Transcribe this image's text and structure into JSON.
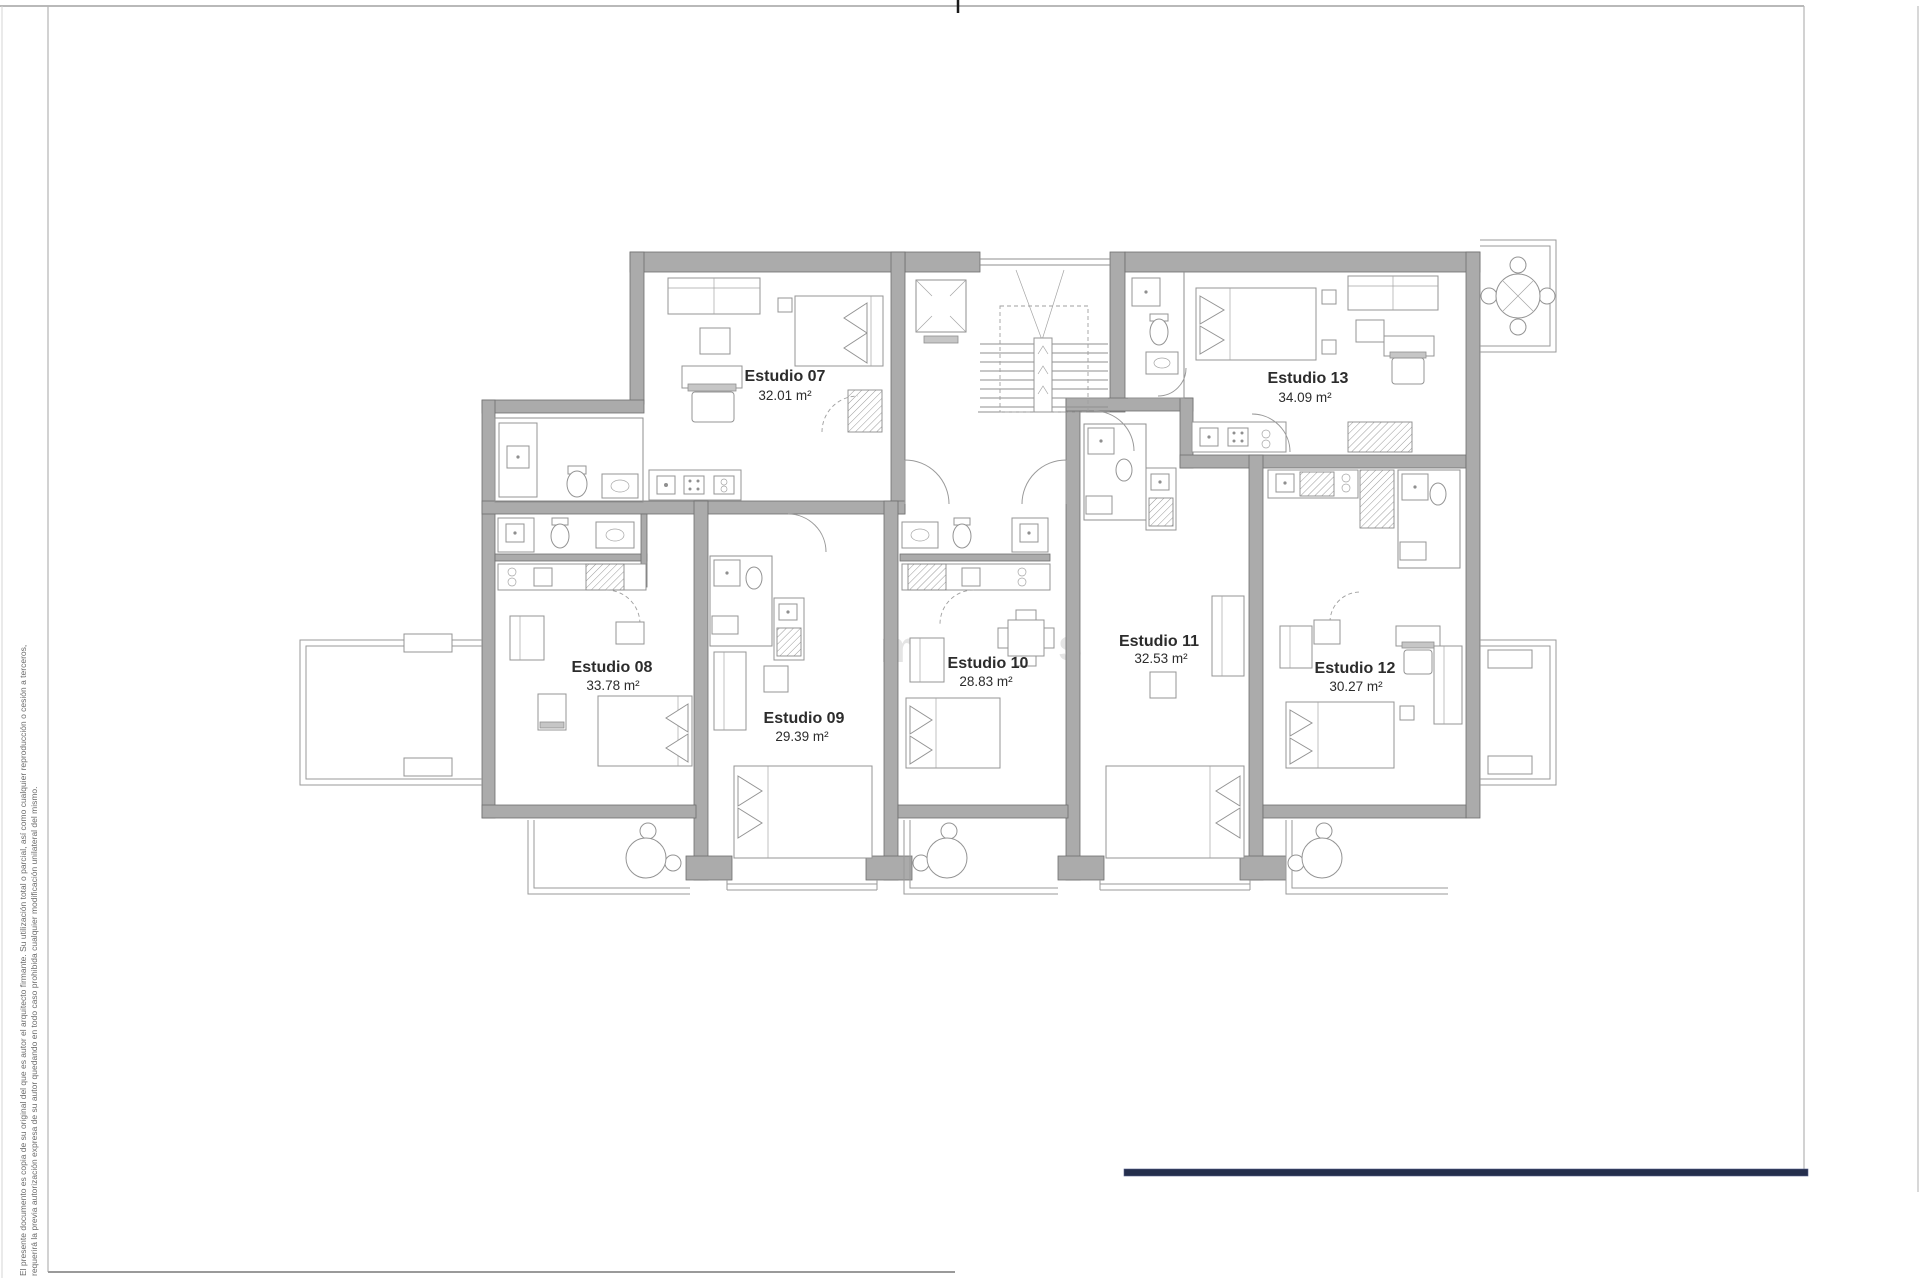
{
  "units": [
    {
      "id": "estudio-07",
      "label": "Estudio 07",
      "area": "32.01 m²"
    },
    {
      "id": "estudio-08",
      "label": "Estudio 08",
      "area": "33.78 m²"
    },
    {
      "id": "estudio-09",
      "label": "Estudio 09",
      "area": "29.39 m²"
    },
    {
      "id": "estudio-10",
      "label": "Estudio 10",
      "area": "28.83 m²"
    },
    {
      "id": "estudio-11",
      "label": "Estudio 11",
      "area": "32.53 m²"
    },
    {
      "id": "estudio-12",
      "label": "Estudio 12",
      "area": "30.27 m²"
    },
    {
      "id": "estudio-13",
      "label": "Estudio 13",
      "area": "34.09 m²"
    }
  ],
  "disclaimer": {
    "line1": "El presente documento es copia de su original del que es autor el arquitecto firmante. Su utilización total o parcial, así como cualquier reproducción o cesión a terceros,",
    "line2": "requerirá la previa autorización expresa de su autor quedando en todo caso prohibida cualquier modificación unilateral del mismo."
  },
  "watermark": {
    "letters": [
      "m",
      "s"
    ]
  },
  "colors": {
    "wall": "#ababab",
    "line": "#8f8f8f",
    "navy_bar": "#242e4c",
    "label_text": "#2c2c2c",
    "disclaimer_text": "#6a6a6a",
    "watermark": "#e4e4e4"
  }
}
